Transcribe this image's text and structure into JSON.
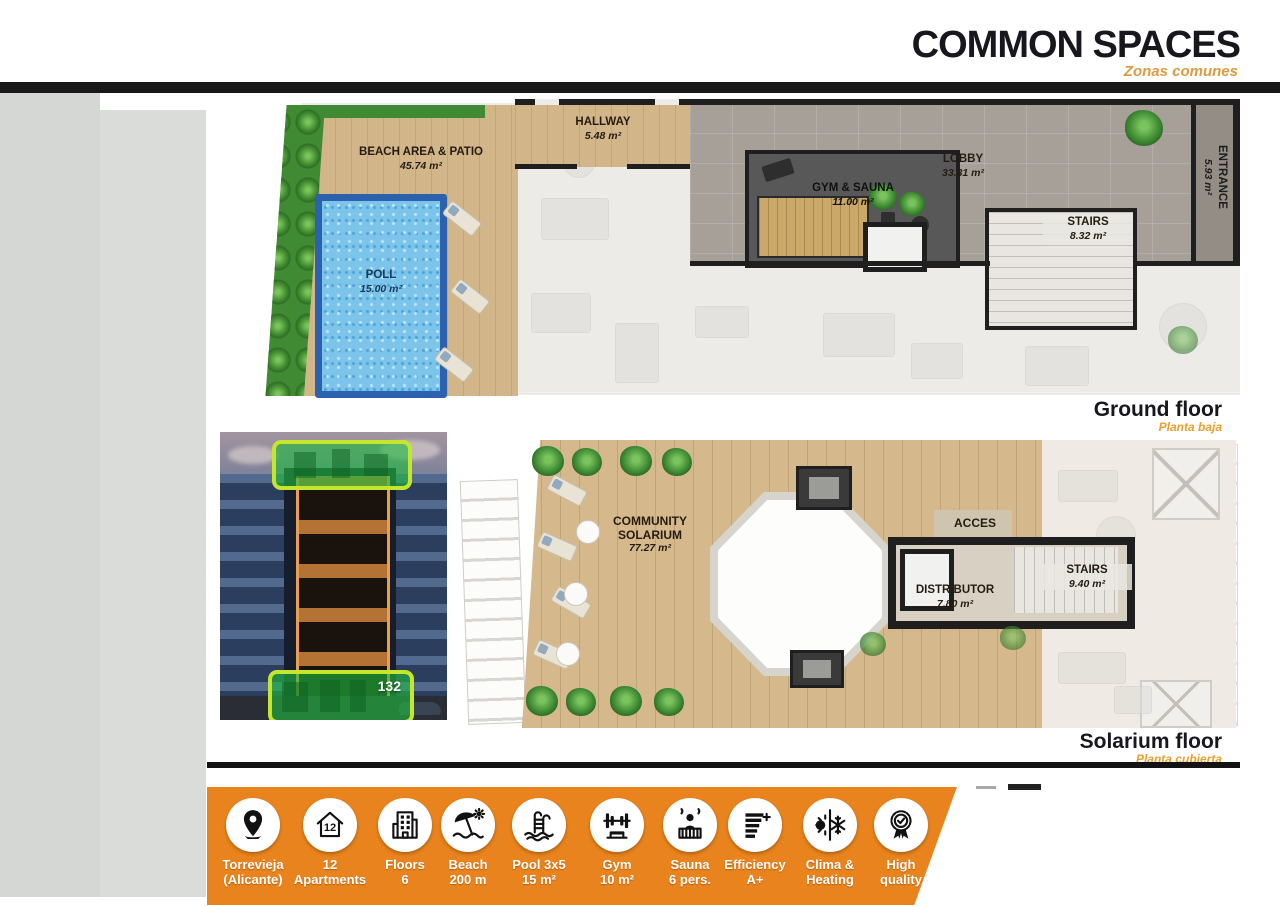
{
  "header": {
    "title": "COMMON SPACES",
    "subtitle": "Zonas comunes"
  },
  "ground_floor": {
    "caption": "Ground floor",
    "caption_sub": "Planta baja",
    "rooms": {
      "beach": {
        "name": "BEACH AREA & PATIO",
        "area": "45.74 m²"
      },
      "pool": {
        "name": "POLL",
        "area": "15.00 m²"
      },
      "hallway": {
        "name": "HALLWAY",
        "area": "5.48 m²"
      },
      "gym": {
        "name": "GYM & SAUNA",
        "area": "11.00 m²"
      },
      "lobby": {
        "name": "LOBBY",
        "area": "33.31 m²"
      },
      "stairs": {
        "name": "STAIRS",
        "area": "8.32 m²"
      },
      "entrance": {
        "name": "ENTRANCE",
        "area": "5.93 m²"
      }
    }
  },
  "solarium_floor": {
    "caption": "Solarium floor",
    "caption_sub": "Planta cubierta",
    "rooms": {
      "solarium": {
        "name": "COMMUNITY SOLARIUM",
        "area": "77.27 m²"
      },
      "acces": {
        "name": "ACCES"
      },
      "distributor": {
        "name": "DISTRIBUTOR",
        "area": "7.80 m²"
      },
      "stairs": {
        "name": "STAIRS",
        "area": "9.40 m²"
      }
    }
  },
  "photo": {
    "overlay_number": "132"
  },
  "features": {
    "items": [
      {
        "icon": "location-pin-icon",
        "line1": "Torrevieja",
        "line2": "(Alicante)",
        "icon_text": ""
      },
      {
        "icon": "house-number-icon",
        "line1": "12",
        "line2": "Apartments",
        "icon_text": "12"
      },
      {
        "icon": "building-icon",
        "line1": "Floors",
        "line2": "6",
        "icon_text": ""
      },
      {
        "icon": "beach-umbrella-icon",
        "line1": "Beach",
        "line2": "200 m",
        "icon_text": ""
      },
      {
        "icon": "pool-ladder-icon",
        "line1": "Pool 3x5",
        "line2": "15 m²",
        "icon_text": ""
      },
      {
        "icon": "gym-barbell-icon",
        "line1": "Gym",
        "line2": "10 m²",
        "icon_text": ""
      },
      {
        "icon": "sauna-icon",
        "line1": "Sauna",
        "line2": "6 pers.",
        "icon_text": ""
      },
      {
        "icon": "efficiency-icon",
        "line1": "Efficiency",
        "line2": "A+",
        "icon_text": ""
      },
      {
        "icon": "climate-icon",
        "line1": "Clima &",
        "line2": "Heating",
        "icon_text": ""
      },
      {
        "icon": "quality-badge-icon",
        "line1": "High",
        "line2": "quality",
        "icon_text": ""
      }
    ]
  },
  "colors": {
    "accent_orange": "#E8831D",
    "subtitle_orange": "#DD9A3E",
    "highlight_green": "#20BA3E",
    "highlight_border": "#C6E62C",
    "pool_blue": "#7CC4EA",
    "wall_black": "#1F1F1F"
  }
}
